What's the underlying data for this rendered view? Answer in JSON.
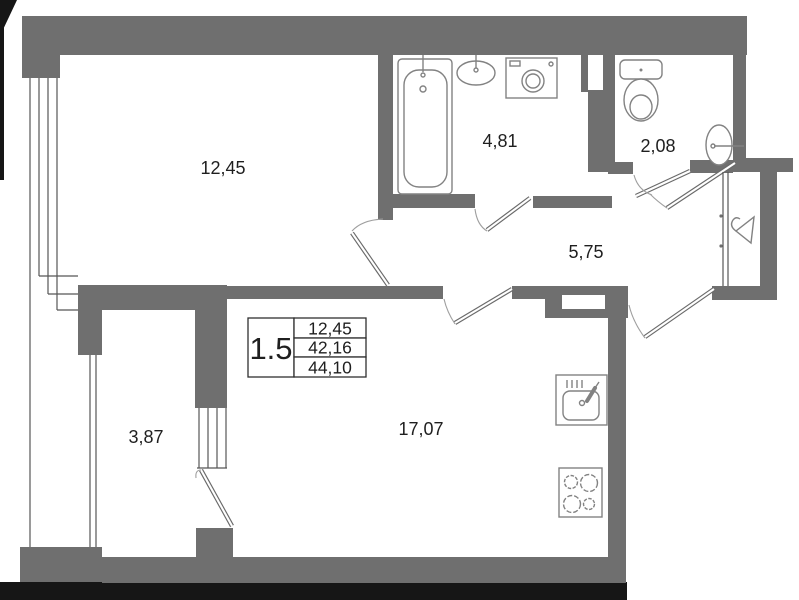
{
  "type": "apartment-floor-plan",
  "legend": {
    "room_count": "1.5",
    "living_area": "12,45",
    "apartment_area": "42,16",
    "total_area": "44,10"
  },
  "rooms": {
    "living_room": {
      "area": "12,45"
    },
    "bathroom": {
      "area": "4,81"
    },
    "wc": {
      "area": "2,08"
    },
    "hallway": {
      "area": "5,75"
    },
    "balcony": {
      "area": "3,87"
    },
    "kitchen_living_room": {
      "area": "17,07"
    }
  },
  "icons": [
    "bathtub-icon",
    "bath-sink-icon",
    "washing-machine-icon",
    "toilet-icon",
    "wc-sink-icon",
    "hanger-icon",
    "kitchen-sink-icon",
    "stove-icon",
    "window-glazing",
    "door-swing"
  ],
  "colors": {
    "wall": "#6f6f6f",
    "scan_edge": "#161616",
    "line": "#565656",
    "fixture": "#828282",
    "text": "#1f1f1f",
    "background": "#ffffff"
  }
}
